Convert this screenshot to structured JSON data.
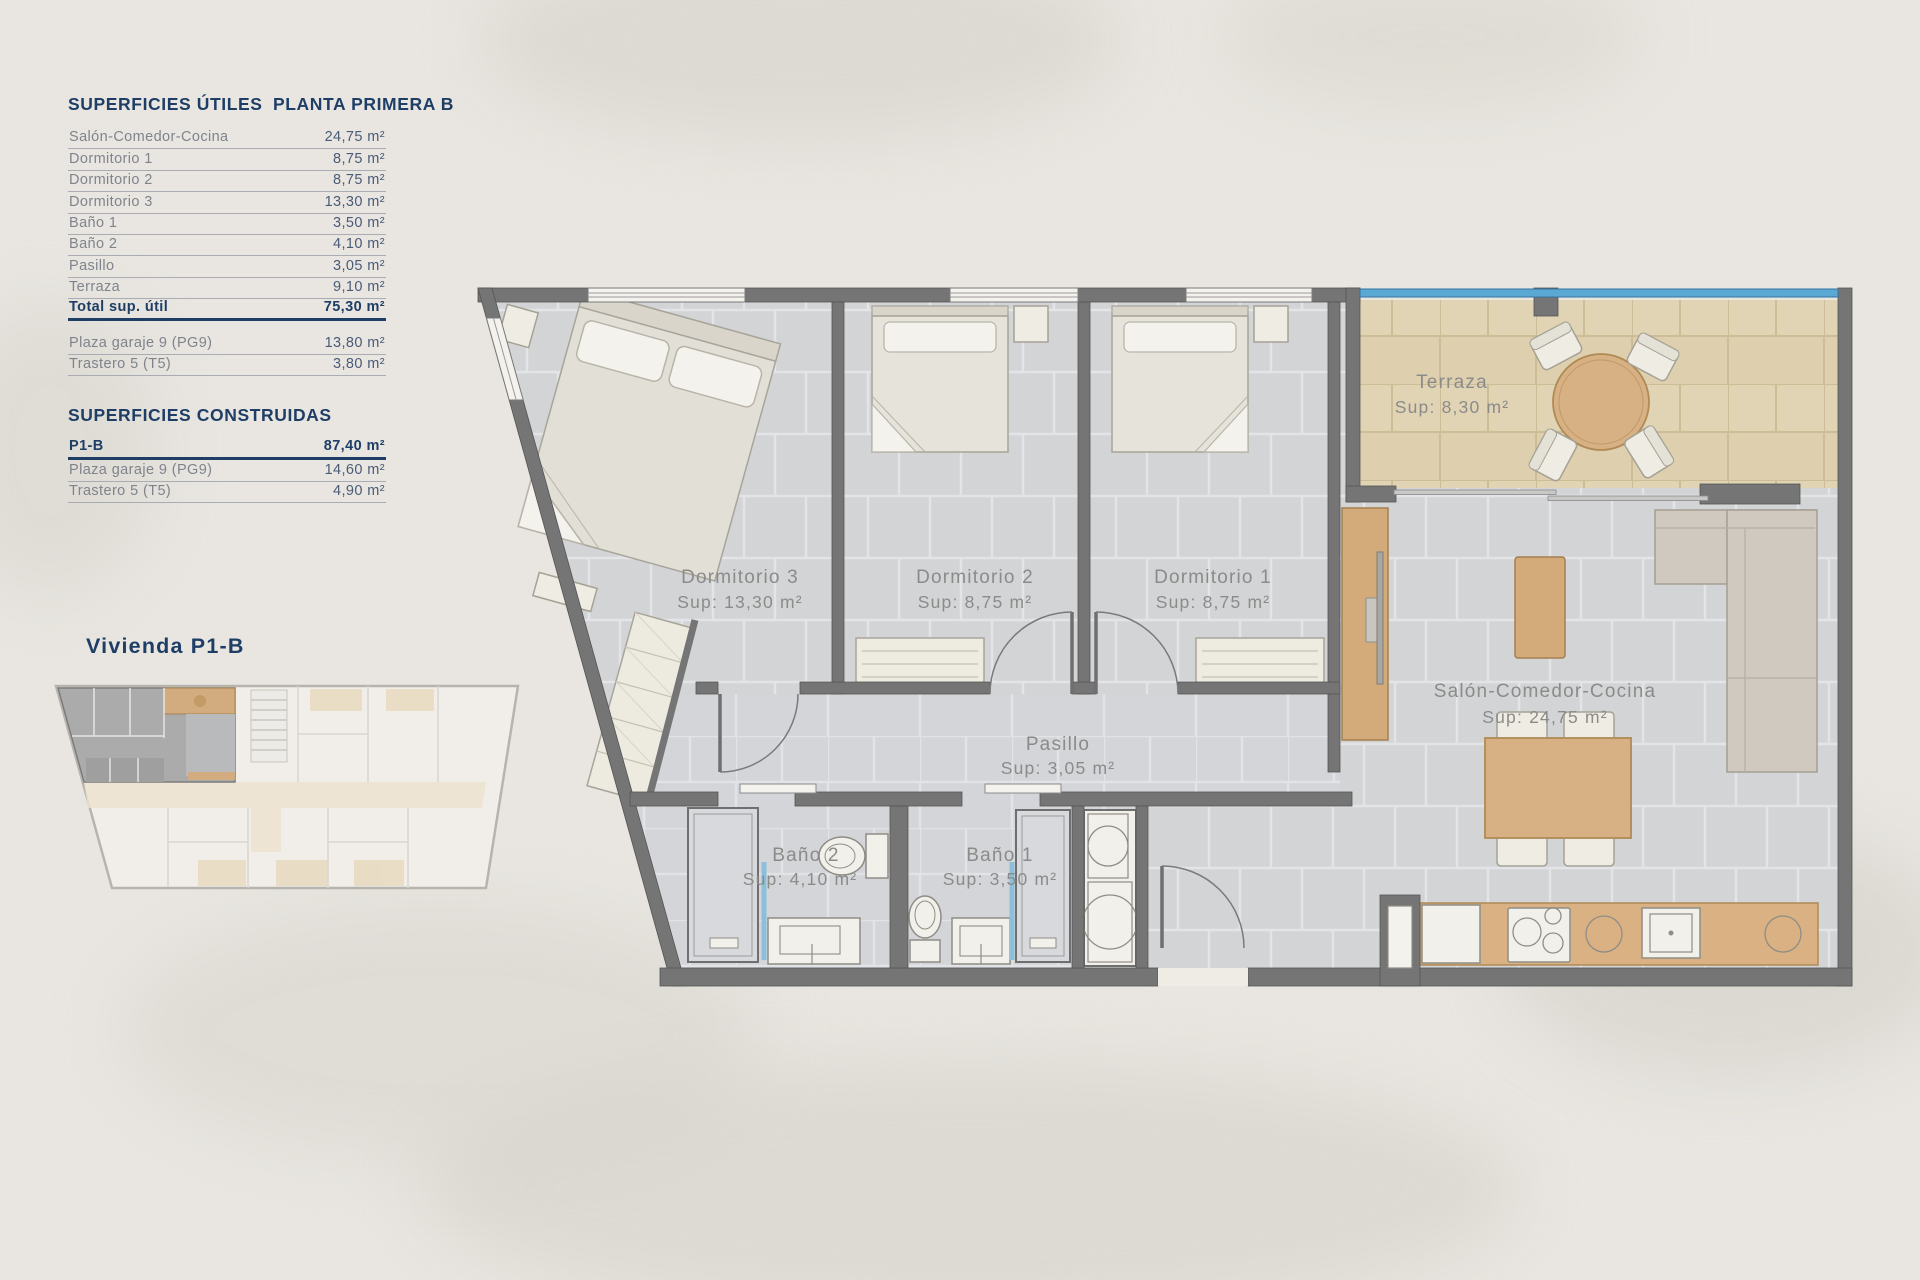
{
  "tables": {
    "utiles": {
      "title": "SUPERFICIES ÚTILES",
      "floor": "PLANTA PRIMERA B",
      "rows": [
        {
          "label": "Salón-Comedor-Cocina",
          "value": "24,75 m²"
        },
        {
          "label": "Dormitorio 1",
          "value": "8,75 m²"
        },
        {
          "label": "Dormitorio 2",
          "value": "8,75 m²"
        },
        {
          "label": "Dormitorio 3",
          "value": "13,30 m²"
        },
        {
          "label": "Baño 1",
          "value": "3,50 m²"
        },
        {
          "label": "Baño 2",
          "value": "4,10 m²"
        },
        {
          "label": "Pasillo",
          "value": "3,05 m²"
        },
        {
          "label": "Terraza",
          "value": "9,10 m²"
        }
      ],
      "total": {
        "label": "Total sup. útil",
        "value": "75,30 m²"
      },
      "annex": [
        {
          "label": "Plaza garaje 9 (PG9)",
          "value": "13,80 m²"
        },
        {
          "label": "Trastero 5 (T5)",
          "value": "3,80 m²"
        }
      ]
    },
    "construidas": {
      "title": "SUPERFICIES CONSTRUIDAS",
      "rows": [
        {
          "label": "P1-B",
          "value": "87,40 m²"
        },
        {
          "label": "Plaza garaje 9 (PG9)",
          "value": "14,60 m²"
        },
        {
          "label": "Trastero 5 (T5)",
          "value": "4,90 m²"
        }
      ]
    }
  },
  "mini_plan": {
    "title": "Vivienda P1-B"
  },
  "plan": {
    "rooms": {
      "d3": {
        "name": "Dormitorio 3",
        "sup": "Sup: 13,30 m²"
      },
      "d2": {
        "name": "Dormitorio 2",
        "sup": "Sup: 8,75 m²"
      },
      "d1": {
        "name": "Dormitorio 1",
        "sup": "Sup: 8,75 m²"
      },
      "terraza": {
        "name": "Terraza",
        "sup": "Sup: 8,30 m²"
      },
      "salon": {
        "name": "Salón-Comedor-Cocina",
        "sup": "Sup: 24,75 m²"
      },
      "pasillo": {
        "name": "Pasillo",
        "sup": "Sup: 3,05 m²"
      },
      "bano2": {
        "name": "Baño 2",
        "sup": "Sup: 4,10 m²"
      },
      "bano1": {
        "name": "Baño 1",
        "sup": "Sup: 3,50 m²"
      }
    }
  },
  "colors": {
    "navy": "#1e3e66",
    "wall": "#757575",
    "floor_gray": "#d2d4d6",
    "floor_bath": "#d3d5d8",
    "terrace_tile": "#ded0af",
    "wood": "#d3ab7b",
    "glass_blue": "#5aa9d4",
    "shower_glass": "#8cc0da",
    "plan_text": "#8b8b89",
    "background": "#e9e6e1"
  }
}
